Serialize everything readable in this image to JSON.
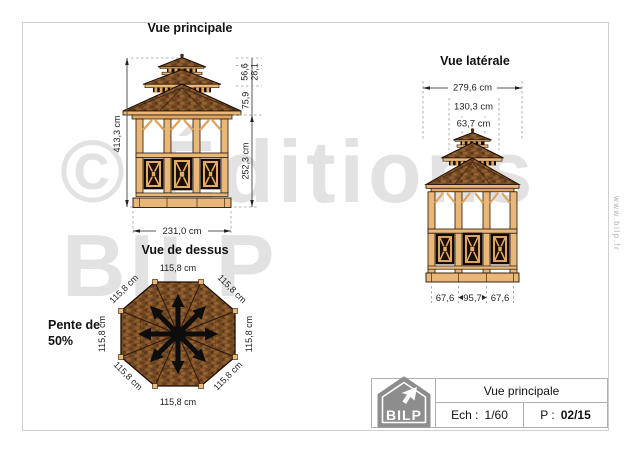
{
  "page": {
    "watermark_line1": "© Éditions",
    "watermark_line2": "BILP",
    "website_vertical": "www.bilp.fr"
  },
  "views": {
    "main": {
      "title": "Vue principale",
      "dim_total_height": "413,3 cm",
      "dim_wall_height": "252,3 cm",
      "dim_roof_height": "75,9",
      "dim_tier2_height": "56,6",
      "dim_cupola_height": "28,1",
      "dim_width": "231,0 cm"
    },
    "side": {
      "title": "Vue latérale",
      "dim_width": "279,6 cm",
      "dim_mid_width": "130,3 cm",
      "dim_cupola_width": "63,7 cm",
      "dim_bottom_left": "67,6",
      "dim_bottom_center": "95,7",
      "dim_bottom_right": "67,6"
    },
    "top": {
      "title": "Vue de dessus",
      "side_length": "115,8 cm",
      "slope_line1": "Pente de",
      "slope_line2": "50%"
    }
  },
  "title_block": {
    "logo_text": "BILP",
    "view_name": "Vue principale",
    "scale_label": "Ech :",
    "scale_value": "1/60",
    "page_label": "P :",
    "page_value": "02/15"
  },
  "colors": {
    "wood_light": "#e9b878",
    "wood_mid": "#dfa562",
    "roof_brown": "#7a4e25",
    "panel_dark": "#1b0d03",
    "dim_text": "#222222",
    "watermark": "#e2e2e2",
    "logo_gray": "#8d8d8d"
  }
}
